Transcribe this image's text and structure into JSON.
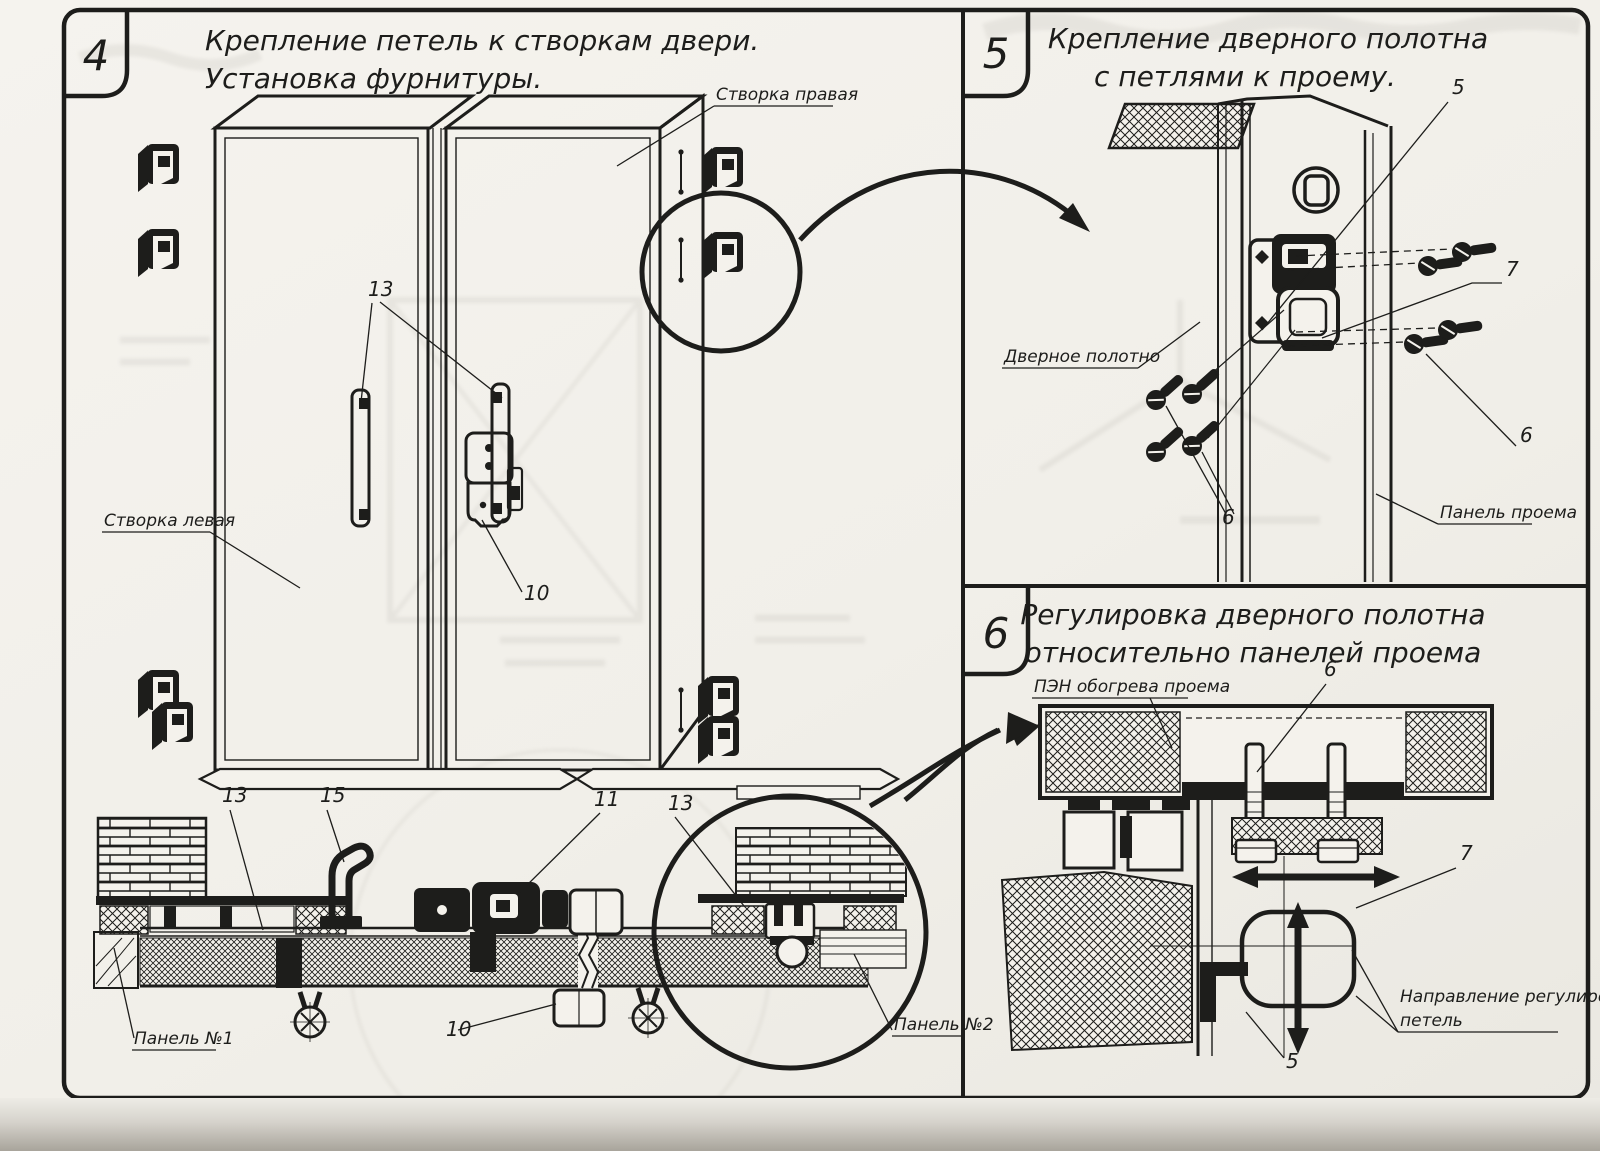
{
  "colors": {
    "ink": "#1d1d1b",
    "paper": "#f1efe9"
  },
  "sections": {
    "s4": {
      "num": "4",
      "title1": "Крепление петель к створкам двери.",
      "title2": "Установка фурнитуры.",
      "label_right_leaf": "Створка правая",
      "label_left_leaf": "Створка левая",
      "label_panel1": "Панель №1",
      "label_panel2": "Панель №2",
      "c13": "13",
      "c10": "10",
      "c15": "15",
      "c11": "11"
    },
    "s5": {
      "num": "5",
      "title1": "Крепление дверного полотна",
      "title2": "с петлями к проему.",
      "label_door_leaf": "Дверное полотно",
      "label_opening_panel": "Панель проема",
      "c5": "5",
      "c6": "6",
      "c7": "7"
    },
    "s6": {
      "num": "6",
      "title1": "Регулировка дверного полотна",
      "title2": "относительно панелей проема",
      "label_heater": "ПЭН обогрева проема",
      "label_dir1": "Направление регулировки",
      "label_dir2": "петель",
      "c5": "5",
      "c6": "6",
      "c7": "7"
    }
  }
}
